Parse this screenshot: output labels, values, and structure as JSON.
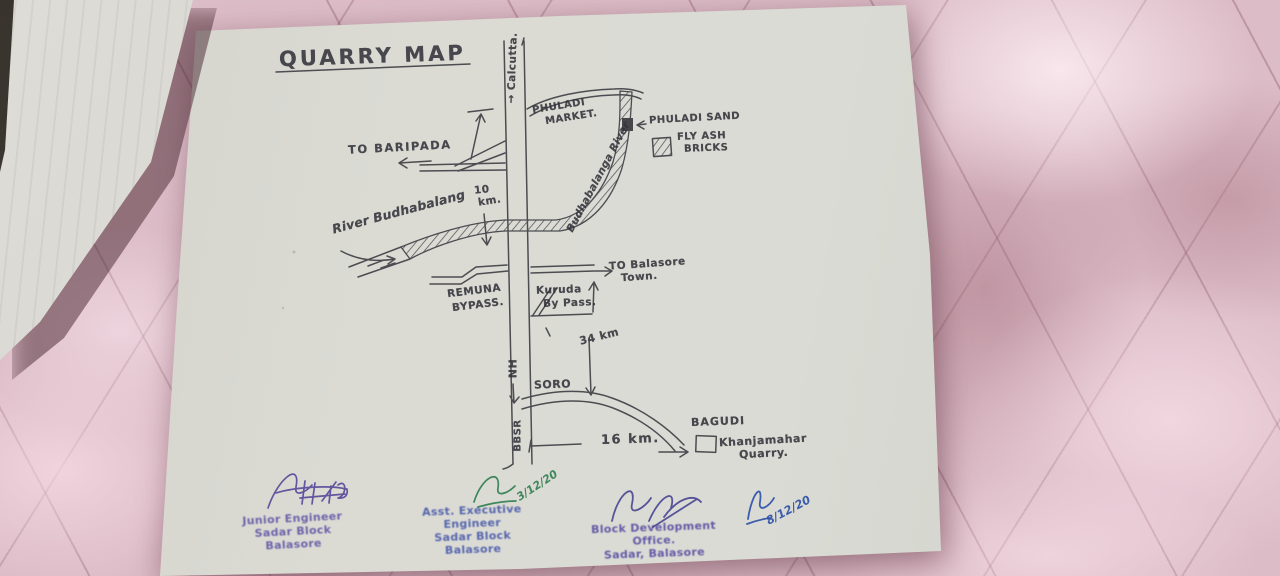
{
  "photo": {
    "description": "hand-drawn quarry route map on a white sheet lying on pink quilted satin fabric",
    "title": "QUARRY MAP",
    "colors": {
      "ink": "#35353c",
      "fabric_pink": "#dcbcc7",
      "paper": "#dadbd4",
      "stamp_purple": "#564aa0",
      "stamp_blue": "#3a4da6",
      "stamp_violet": "#4b3f9e",
      "sig_green": "#2e7d4f",
      "sig_blue": "#2b4fa8"
    },
    "map": {
      "labels": {
        "calcutta": "→ Calcutta.",
        "phuladi_market_1": "PHULADI",
        "phuladi_market_2": "MARKET.",
        "phuladi_sand": "PHULADI SAND",
        "legend_fly_ash_1": "FLY ASH",
        "legend_fly_ash_2": "BRICKS",
        "to_baripada": "TO BARIPADA",
        "dist_10_value": "10",
        "dist_10_unit": "km.",
        "river_left": "River Budhabalang",
        "river_curve": "Budhabalanga River",
        "remuna_1": "REMUNA",
        "remuna_2": "BYPASS.",
        "to_balasore_1": "TO Balasore",
        "to_balasore_2": "Town.",
        "kuruda_1": "Kuruda",
        "kuruda_2": "By Pass.",
        "dist_34": "34 km",
        "nh": "NH",
        "soro": "SORO",
        "bbsr": "BBSR",
        "dist_16": "16 km.",
        "bagudi": "BAGUDI",
        "quarry_1": "Khanjamahar",
        "quarry_2": "Quarry."
      }
    },
    "stamps": [
      {
        "lines": [
          "Junior Engineer",
          "Sadar Block",
          "Balasore"
        ]
      },
      {
        "lines": [
          "Asst. Executive Engineer",
          "Sadar Block",
          "Balasore"
        ]
      },
      {
        "lines": [
          "Block Development Office.",
          "Sadar, Balasore"
        ]
      }
    ],
    "signatures": [
      {
        "ink": "purple",
        "date": ""
      },
      {
        "ink": "green",
        "date": "3/12/20"
      },
      {
        "ink": "violet",
        "date": ""
      },
      {
        "ink": "blue",
        "date": "8/12/20"
      }
    ]
  }
}
